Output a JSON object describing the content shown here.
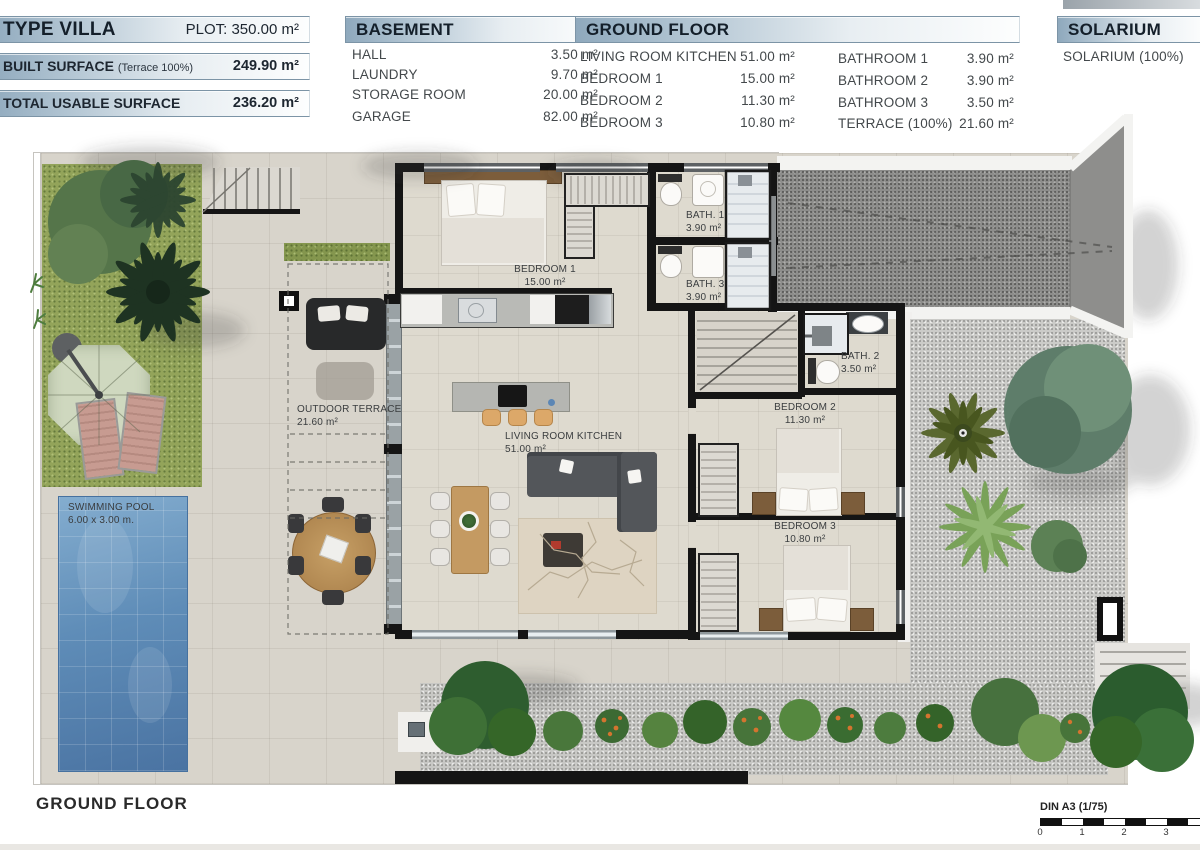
{
  "header": {
    "plot": {
      "title": "TYPE VILLA",
      "value": "PLOT: 350.00 m²"
    },
    "built": {
      "label": "BUILT SURFACE",
      "note": "(Terrace 100%)",
      "value": "249.90 m²"
    },
    "usable": {
      "label": "TOTAL USABLE SURFACE",
      "value": "236.20 m²"
    },
    "basement": {
      "title": "BASEMENT",
      "rows": [
        {
          "label": "HALL",
          "value": "3.50 m²"
        },
        {
          "label": "LAUNDRY",
          "value": "9.70 m²"
        },
        {
          "label": "STORAGE ROOM",
          "value": "20.00 m²"
        },
        {
          "label": "GARAGE",
          "value": "82.00 m²"
        }
      ]
    },
    "ground_floor": {
      "title": "GROUND FLOOR",
      "left": [
        {
          "label": "LIVING ROOM KITCHEN",
          "value": "51.00 m²"
        },
        {
          "label": "BEDROOM 1",
          "value": "15.00 m²"
        },
        {
          "label": "BEDROOM 2",
          "value": "11.30 m²"
        },
        {
          "label": "BEDROOM 3",
          "value": "10.80 m²"
        }
      ],
      "right": [
        {
          "label": "BATHROOM 1",
          "value": "3.90 m²"
        },
        {
          "label": "BATHROOM 2",
          "value": "3.90 m²"
        },
        {
          "label": "BATHROOM 3",
          "value": "3.50 m²"
        },
        {
          "label": "TERRACE (100%)",
          "value": "21.60 m²"
        }
      ]
    },
    "solarium": {
      "title": "SOLARIUM",
      "row_label": "SOLARIUM (100%)"
    }
  },
  "plan": {
    "rooms": {
      "bedroom1": {
        "name": "BEDROOM 1",
        "area": "15.00 m²"
      },
      "bath1": {
        "name": "BATH. 1",
        "area": "3.90 m²"
      },
      "bath3": {
        "name": "BATH. 3",
        "area": "3.90 m²"
      },
      "bath2": {
        "name": "BATH. 2",
        "area": "3.50 m²"
      },
      "bedroom2": {
        "name": "BEDROOM 2",
        "area": "11.30 m²"
      },
      "bedroom3": {
        "name": "BEDROOM 3",
        "area": "10.80 m²"
      },
      "terrace": {
        "name": "OUTDOOR TERRACE",
        "area": "21.60 m²"
      },
      "living": {
        "name": "LIVING ROOM KITCHEN",
        "area": "51.00 m²"
      },
      "pool": {
        "name": "SWIMMING POOL",
        "area": "6.00 x 3.00 m."
      }
    }
  },
  "footer": {
    "floor_label": "GROUND FLOOR",
    "scale_label": "DIN A3 (1/75)",
    "ticks": [
      "0",
      "1",
      "2",
      "3"
    ]
  },
  "colors": {
    "accent": "#8fa9bd",
    "wall": "#151515",
    "pool": "#5d8cba",
    "grass": "#93a45a",
    "driveway": "#8d8d8b"
  }
}
